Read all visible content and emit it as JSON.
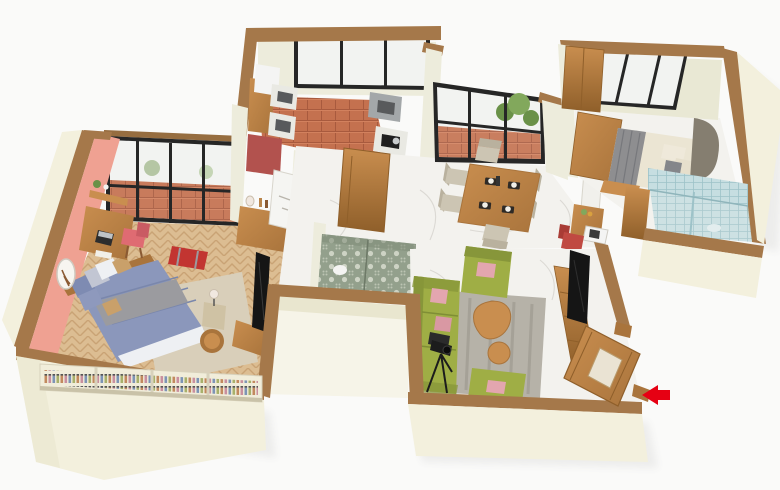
{
  "scene": {
    "type": "isometric-3d-floor-plan",
    "background": "#fafaf9",
    "rooms": [
      {
        "name": "master-bedroom"
      },
      {
        "name": "balcony"
      },
      {
        "name": "kitchen"
      },
      {
        "name": "hallway"
      },
      {
        "name": "dining-area"
      },
      {
        "name": "bedroom-2"
      },
      {
        "name": "bathroom-1"
      },
      {
        "name": "bathroom-2"
      },
      {
        "name": "living-room"
      },
      {
        "name": "entrance"
      }
    ],
    "furniture": [
      "double-bed-blue",
      "desk-with-laptop",
      "pink-chair",
      "dresser",
      "tv-master",
      "bottle-shelf",
      "red-duffel-bag",
      "round-stool",
      "side-lamp-table",
      "wall-mirror",
      "kitchen-cabinets",
      "kitchen-sink-counters",
      "gas-stove-counter",
      "dining-table",
      "dining-chairs",
      "potted-plant",
      "study-desk",
      "microwave",
      "red-chair",
      "wardrobe",
      "double-bed-beige",
      "shower-enclosure",
      "green-sofa",
      "green-armchairs",
      "leaf-coffee-table",
      "camera-tripod",
      "tv-console",
      "entry-door-open"
    ],
    "indicators": {
      "entrance_arrow": {
        "direction": "left",
        "color": "#e60013"
      }
    }
  },
  "colors": {
    "background": "#fafaf9",
    "wall_cap": "#a5784a",
    "wall_cap_dark": "#966d40",
    "wall_outer": "#f3f0dd",
    "wall_outer_shade": "#e9e6cf",
    "wall_inner": "#edecdc",
    "wall_inner_olive": "#e9e8d4",
    "wall_pink": "#efa192",
    "notch_inner": "#f6f4e8",
    "floor_wood_base": "#dcbd92",
    "floor_wood_line": "#c9a375",
    "marble": "#f3f2ee",
    "marble_vein": "#d8d6d0",
    "terracotta": "#c4714f",
    "terracotta_line": "#a85a3e",
    "frame_black": "#262626",
    "glass": "#f2f3f1",
    "wood": "#c98e4f",
    "wood_dark": "#a9743c",
    "wood_deep": "#8f5f2a",
    "sofa_green": "#9fae45",
    "sofa_green_dark": "#87963a",
    "cushion_pink": "#e3a6af",
    "rug": "#b6b2a8",
    "rug_dark": "#938f85",
    "rug_light": "#d9cfba",
    "bed_blue": "#8b97bb",
    "bed_blue_dark": "#7e8bb2",
    "sheet_white": "#eef0f3",
    "blanket_grey": "#9b9b9f",
    "bed2_cream": "#ebe5d3",
    "bed2_grey": "#8e8e90",
    "headboard": "#857e70",
    "tile_blue": "#c6dee1",
    "tile_blue_line": "#9dc2c8",
    "damask_base": "#93a08c",
    "damask_motif": "#cdd3c4",
    "chair_beige": "#ccc5b3",
    "chair_beige_dark": "#b9b19e",
    "chair_pink": "#df6b72",
    "chair_red": "#c04a42",
    "counter_red": "#b2524e",
    "counter_white": "#e9e9e3",
    "counter_grey": "#a3a7a9",
    "appliance_white": "#f4f4f3",
    "steel": "#585a5c",
    "tv_black": "#151515",
    "plant_green": "#6a9148",
    "plant_green_light": "#82a85c",
    "bag_red": "#c23531",
    "arrow_red": "#e60013",
    "shelf_cream": "#f1edda",
    "lamp_white": "#f1e8e0"
  }
}
